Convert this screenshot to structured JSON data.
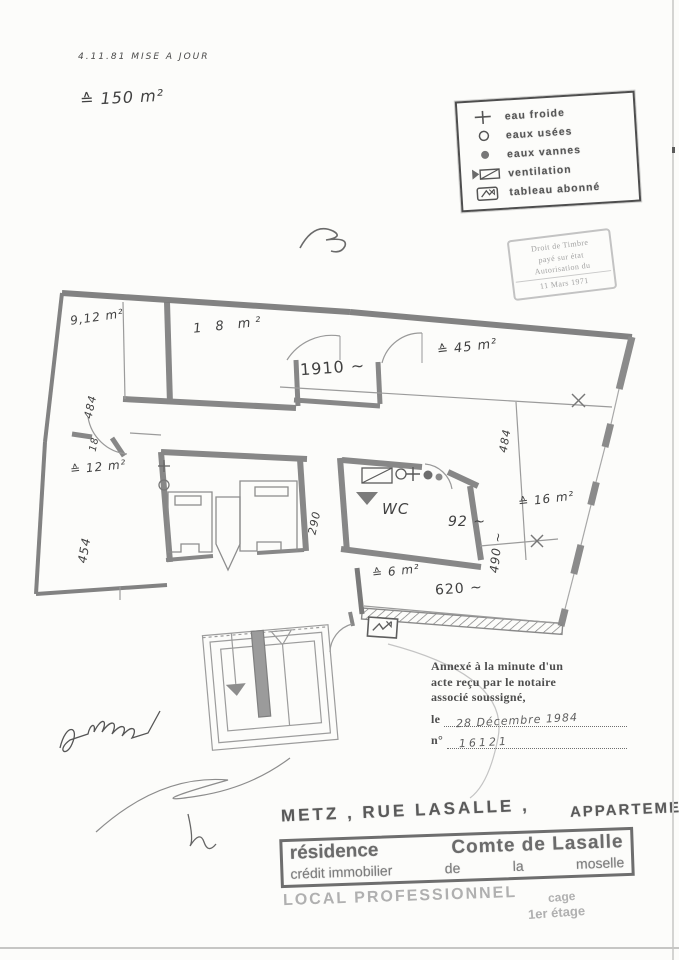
{
  "annotations": {
    "update_note": "4.11.81   MISE  A  JOUR",
    "total_area": "≙ 150 m²"
  },
  "legend": {
    "items": [
      {
        "symbol": "cross-eau-froide",
        "label": "eau froide"
      },
      {
        "symbol": "circle-outline",
        "label": "eaux usées"
      },
      {
        "symbol": "circle-filled",
        "label": "eaux vannes"
      },
      {
        "symbol": "ventilation-duct",
        "label": "ventilation"
      },
      {
        "symbol": "meter-box-arrow",
        "label": "tableau abonné"
      }
    ]
  },
  "tax_stamp": {
    "lines": [
      "Droit de Timbre",
      "payé sur état",
      "Autorisation  du",
      "11 Mars 1971"
    ]
  },
  "plan": {
    "rooms": {
      "r912": "9,12 m²",
      "r18": "1 8  m²",
      "r45": "≙ 45 m²",
      "r12": "≙ 12 m²",
      "r16": "≙ 16 m²",
      "r6": "≙ 6 m²",
      "wc": "WC"
    },
    "dimensions": {
      "d1910": "1910 ~",
      "d484_left": "484",
      "d18": "18",
      "d454": "454",
      "d290": "290",
      "d484_right": "484",
      "d92": "92 ~",
      "d490": "490 ~",
      "d620": "620 ~"
    }
  },
  "notary": {
    "line1": "Annexé à la minute d'un",
    "line2": "acte reçu par le notaire",
    "line3": "associé soussigné,",
    "date_prefix": "le",
    "date_value": "28 Décembre 1984",
    "number_prefix": "n°",
    "number_value": "16121"
  },
  "stamps": {
    "line_city": "METZ ,  RUE  LASALLE ,",
    "line_type": "APPARTEMENTS",
    "residence_l1a": "résidence",
    "residence_l1b": "Comte  de  Lasalle",
    "residence_l2a": "crédit  immobilier",
    "residence_l2b": "de",
    "residence_l2c": "la",
    "residence_l2d": "moselle",
    "local_line": "LOCAL  PROFESSIONNEL",
    "cage": "cage",
    "floor": "1er  étage"
  }
}
